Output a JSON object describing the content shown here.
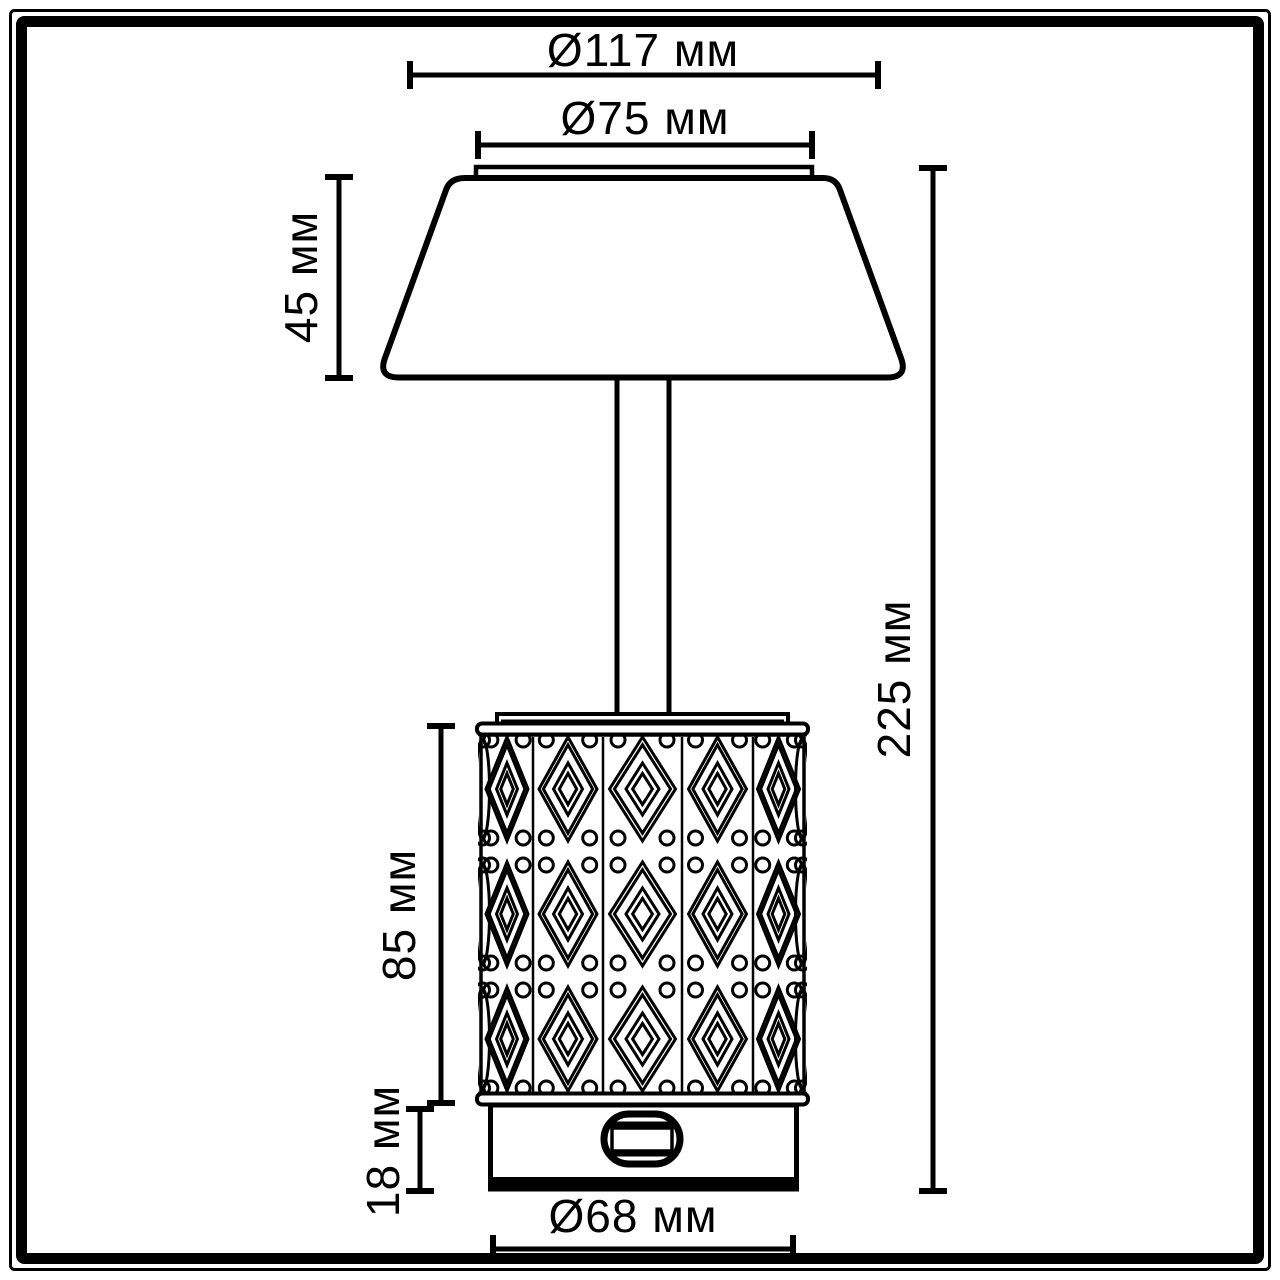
{
  "diagram": {
    "type": "technical-dimension-drawing",
    "subject": "table-lamp",
    "colors": {
      "line": "#000000",
      "background": "#ffffff"
    },
    "dimensions": {
      "top_diameter": "Ø117 мм",
      "shade_inner_diameter": "Ø75 мм",
      "shade_height": "45 мм",
      "crystal_height": "85 мм",
      "base_height": "18 мм",
      "total_height": "225 мм",
      "base_diameter": "Ø68 мм"
    }
  }
}
